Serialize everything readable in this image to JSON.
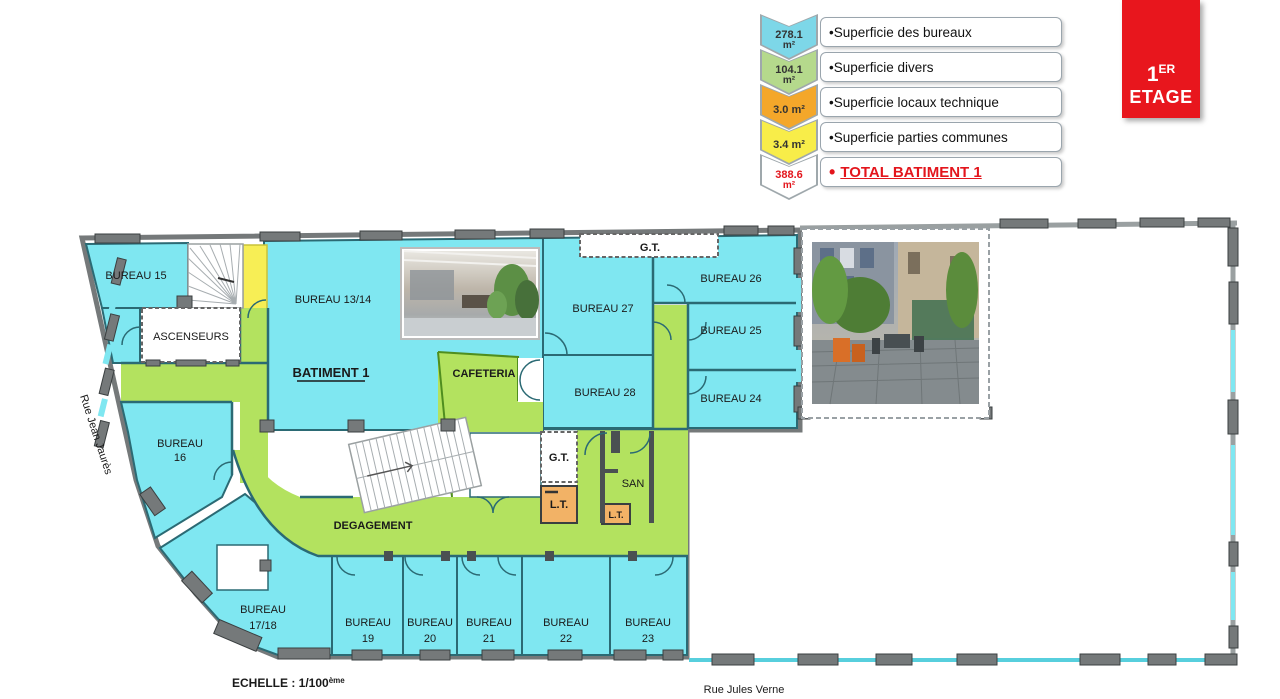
{
  "floor_badge": {
    "number": "1",
    "superscript": "ER",
    "word": "ETAGE",
    "color": "#e8161d"
  },
  "legend": {
    "items": [
      {
        "value_line1": "278.1",
        "value_line2": "m²",
        "label": "•Superficie des bureaux",
        "chevron_color": "#7dd7e8"
      },
      {
        "value_line1": "104.1",
        "value_line2": "m²",
        "label": "•Superficie divers",
        "chevron_color": "#b5d98c"
      },
      {
        "value_line1": "3.0 m²",
        "value_line2": "",
        "label": "•Superficie locaux technique",
        "chevron_color": "#f4a72a"
      },
      {
        "value_line1": "3.4 m²",
        "value_line2": "",
        "label": "•Superficie parties communes",
        "chevron_color": "#f8ed49"
      },
      {
        "value_line1": "388.6",
        "value_line2": "m²",
        "bullet": "•",
        "label": "TOTAL BATIMENT 1",
        "chevron_color": "#ffffff",
        "text_color": "#e3151c"
      }
    ]
  },
  "plan": {
    "labels": {
      "bureau15": "BUREAU 15",
      "bureau13_14": "BUREAU 13/14",
      "batiment1": "BATIMENT 1",
      "ascenseurs": "ASCENSEURS",
      "bureau16": {
        "l1": "BUREAU",
        "l2": "16"
      },
      "cafeteria": "CAFETERIA",
      "degagement": "DEGAGEMENT",
      "bureau27": "BUREAU 27",
      "bureau28": "BUREAU 28",
      "bureau26": "BUREAU 26",
      "bureau25": "BUREAU 25",
      "bureau24": "BUREAU 24",
      "gt_top": "G.T.",
      "gt_mid": "G.T.",
      "lt_1": "L.T.",
      "lt_2": "L.T.",
      "san": "SAN",
      "bureau17_18": {
        "l1": "BUREAU",
        "l2": "17/18"
      },
      "bureau19": {
        "l1": "BUREAU",
        "l2": "19"
      },
      "bureau20": {
        "l1": "BUREAU",
        "l2": "20"
      },
      "bureau21": {
        "l1": "BUREAU",
        "l2": "21"
      },
      "bureau22": {
        "l1": "BUREAU",
        "l2": "22"
      },
      "bureau23": {
        "l1": "BUREAU",
        "l2": "23"
      }
    },
    "streets": {
      "left": "Rue Jean Jaurès",
      "bottom": "Rue Jules Verne"
    },
    "scale": {
      "text": "ECHELLE : 1/100",
      "sup": "ème"
    },
    "colors": {
      "bureaux": "#7fe7f1",
      "divers": "#b3e25f",
      "technique": "#f2b266",
      "communes": "#f7ee55",
      "total_red": "#e3151c",
      "walls": "#75797a"
    }
  }
}
